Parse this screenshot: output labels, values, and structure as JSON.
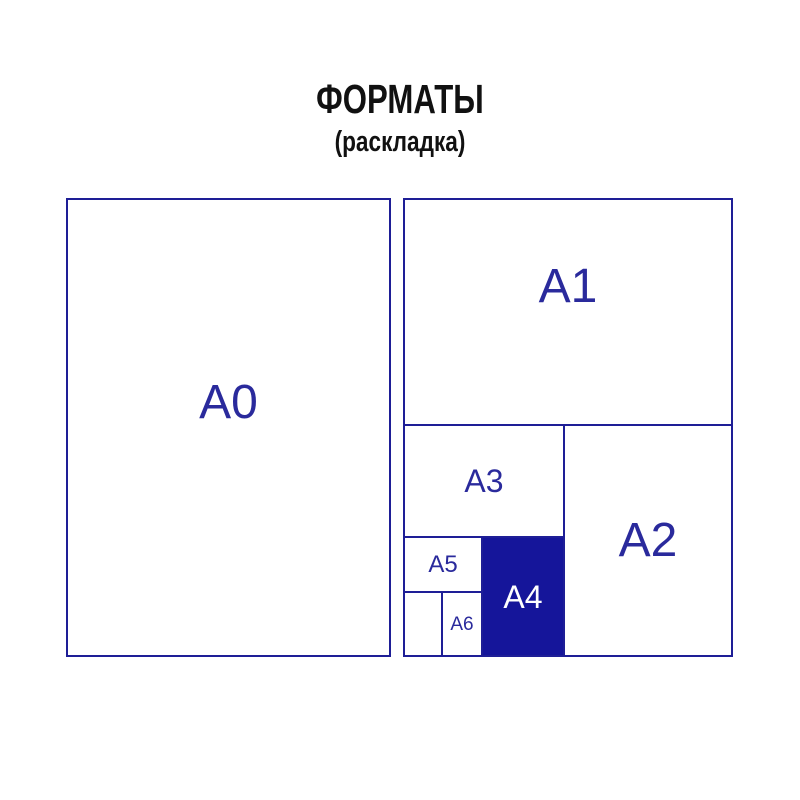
{
  "title": "ФОРМАТЫ",
  "subtitle": "(раскладка)",
  "colors": {
    "line": "#1e1e96",
    "label": "#2a2a9c",
    "a4_fill": "#15159a",
    "a4_label": "#ffffff",
    "title_text": "#111111",
    "background": "#ffffff"
  },
  "formats": [
    {
      "id": "a0",
      "label": "A0"
    },
    {
      "id": "a1",
      "label": "A1"
    },
    {
      "id": "a2",
      "label": "A2"
    },
    {
      "id": "a3",
      "label": "A3"
    },
    {
      "id": "a4",
      "label": "A4"
    },
    {
      "id": "a5",
      "label": "A5"
    },
    {
      "id": "a6",
      "label": "A6"
    }
  ]
}
